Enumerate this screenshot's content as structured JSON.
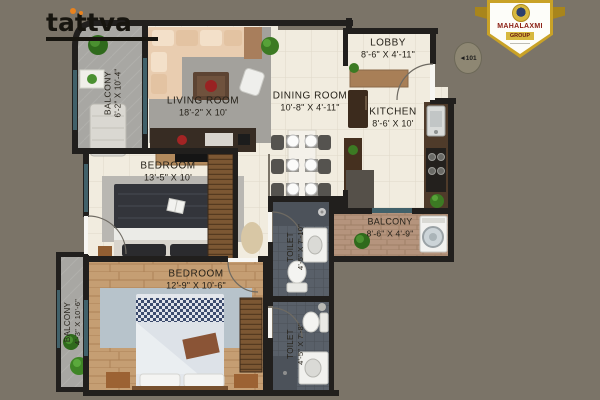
{
  "canvas": {
    "width": 600,
    "height": 400,
    "background": "#7b7468"
  },
  "branding": {
    "logo_text": "tattva",
    "badge_title": "MAHALAXMI",
    "badge_subtitle": "GROUP",
    "unit_plate": "◄101"
  },
  "rooms": {
    "balcony_top": {
      "name": "BALCONY",
      "dims": "6'-2\" X 10'-4\""
    },
    "living": {
      "name": "LIVING ROOM",
      "dims": "18'-2\" X 10'"
    },
    "dining": {
      "name": "DINING ROOM",
      "dims": "10'-8\" X 4'-11\""
    },
    "lobby": {
      "name": "LOBBY",
      "dims": "8'-6\" X 4'-11\""
    },
    "kitchen": {
      "name": "KITCHEN",
      "dims": "8'-6' X 10'"
    },
    "bedroom1": {
      "name": "BEDROOM",
      "dims": "13'-5\" X 10'"
    },
    "bedroom2": {
      "name": "BEDROOM",
      "dims": "12'-9\" X 10'-6\""
    },
    "toilet1": {
      "name": "TOILET",
      "dims": "4'-5\" X 7'-10\""
    },
    "toilet2": {
      "name": "TOILET",
      "dims": "4'-5\" X 7'-8\""
    },
    "balcony_left": {
      "name": "BALCONY",
      "dims": "4'-3\" X 10'-6\""
    },
    "balcony_right": {
      "name": "BALCONY",
      "dims": "8'-6\" X 4'-9\""
    }
  },
  "colors": {
    "wall": "#211f1d",
    "tile_floor": "#f1ecdf",
    "stone_floor": "#a8a7a3",
    "wood_floor": "#c59e73",
    "dark_tile_floor": "#596069",
    "brick_floor": "#b5947d",
    "glass": "#41616a",
    "logo_accent": "#e8821e",
    "badge_maroon": "#8a1d12",
    "badge_gold": "#c9a227"
  }
}
